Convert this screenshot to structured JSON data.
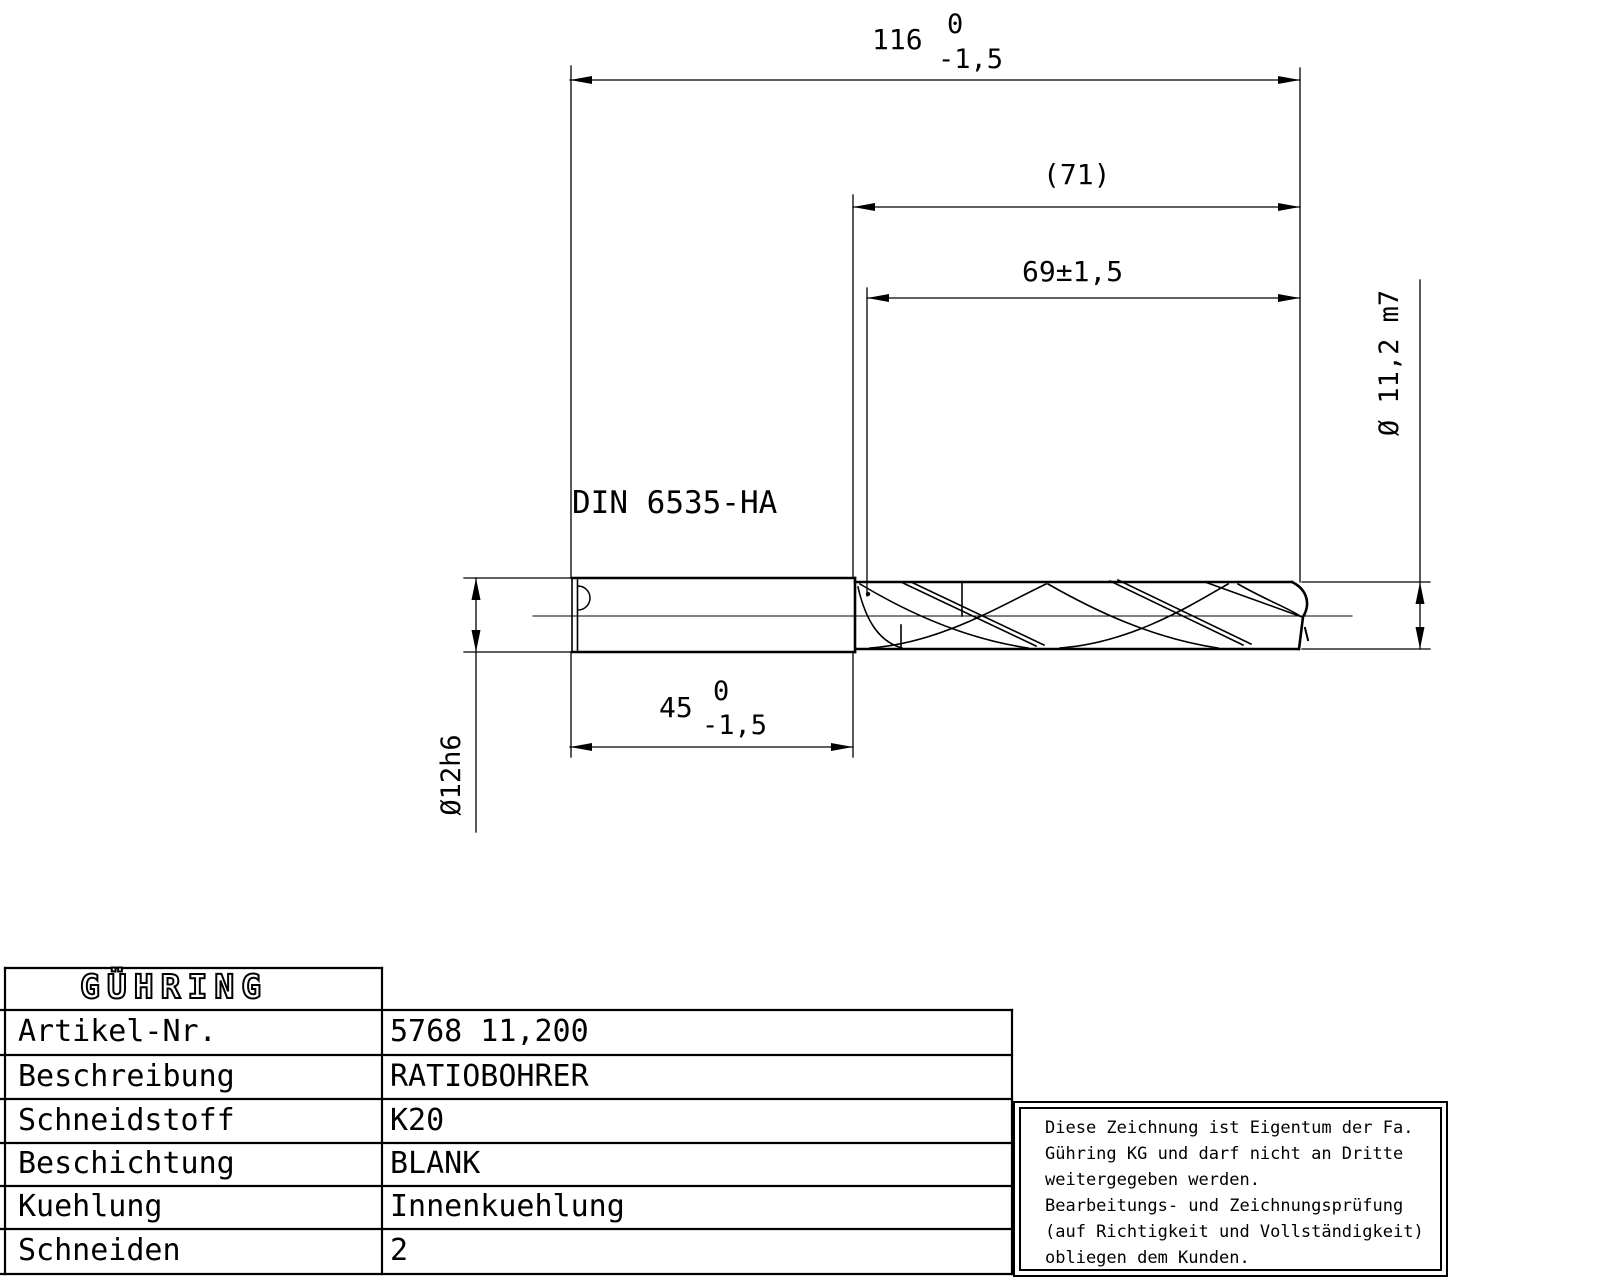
{
  "colors": {
    "ink": "#000000",
    "paper": "#ffffff"
  },
  "drawing": {
    "shank_standard": "DIN 6535-HA",
    "dims": {
      "overall_length": {
        "value": "116",
        "tol_upper": "0",
        "tol_lower": "-1,5"
      },
      "flute_length_ref": "(71)",
      "flute_length": "69±1,5",
      "shank_length": {
        "value": "45",
        "tol_upper": "0",
        "tol_lower": "-1,5"
      },
      "shank_diameter": "Ø12h6",
      "cutting_diameter": "Ø 11,2 m7"
    }
  },
  "titleblock": {
    "logo": "GÜHRING",
    "rows": [
      {
        "label": "Artikel-Nr.",
        "value": "5768 11,200"
      },
      {
        "label": "Beschreibung",
        "value": "RATIOBOHRER"
      },
      {
        "label": "Schneidstoff",
        "value": "K20"
      },
      {
        "label": "Beschichtung",
        "value": "BLANK"
      },
      {
        "label": "Kuehlung",
        "value": "Innenkuehlung"
      },
      {
        "label": "Schneiden",
        "value": "2"
      }
    ]
  },
  "notice": {
    "lines": [
      "Diese Zeichnung ist Eigentum der Fa.",
      "Gühring KG und darf nicht an Dritte",
      "weitergegeben werden.",
      "Bearbeitungs- und Zeichnungsprüfung",
      "(auf Richtigkeit und Vollständigkeit)",
      "obliegen dem Kunden."
    ]
  }
}
